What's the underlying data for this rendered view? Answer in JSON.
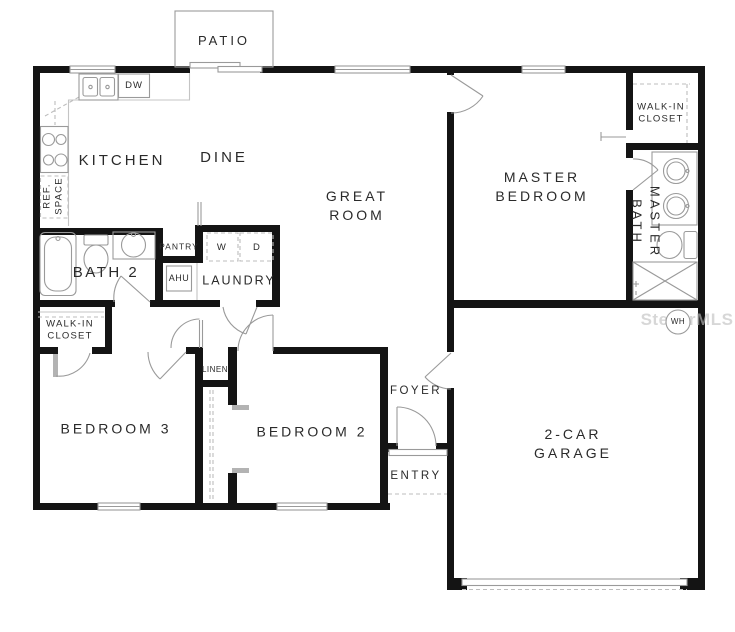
{
  "title": "Floor plan",
  "watermark": "StellarMLS",
  "colors": {
    "wall": "#141414",
    "fixture_line": "#9a9a9a",
    "label_text": "#2a2a2a",
    "dashed_line": "#bdbdbd",
    "watermark_text": "#bfbfbf"
  },
  "rooms": {
    "patio": "PATIO",
    "kitchen": "KITCHEN",
    "dine": "DINE",
    "great_room": "GREAT\nROOM",
    "master_bedroom": "MASTER\nBEDROOM",
    "master_closet": "WALK-IN\nCLOSET",
    "master_bath": "MASTER\nBATH",
    "bath2": "BATH 2",
    "pantry": "PANTRY",
    "laundry": "LAUNDRY",
    "bedroom3_closet": "WALK-IN\nCLOSET",
    "bedroom3": "BEDROOM 3",
    "bedroom2": "BEDROOM 2",
    "linen": "LINEN",
    "foyer": "FOYER",
    "entry": "ENTRY",
    "garage": "2-CAR\nGARAGE"
  },
  "fixtures": {
    "dishwasher": "DW",
    "ref_space": "REF.\nSPACE",
    "ahu": "AHU",
    "washer": "W",
    "dryer": "D",
    "water_heater": "WH"
  }
}
